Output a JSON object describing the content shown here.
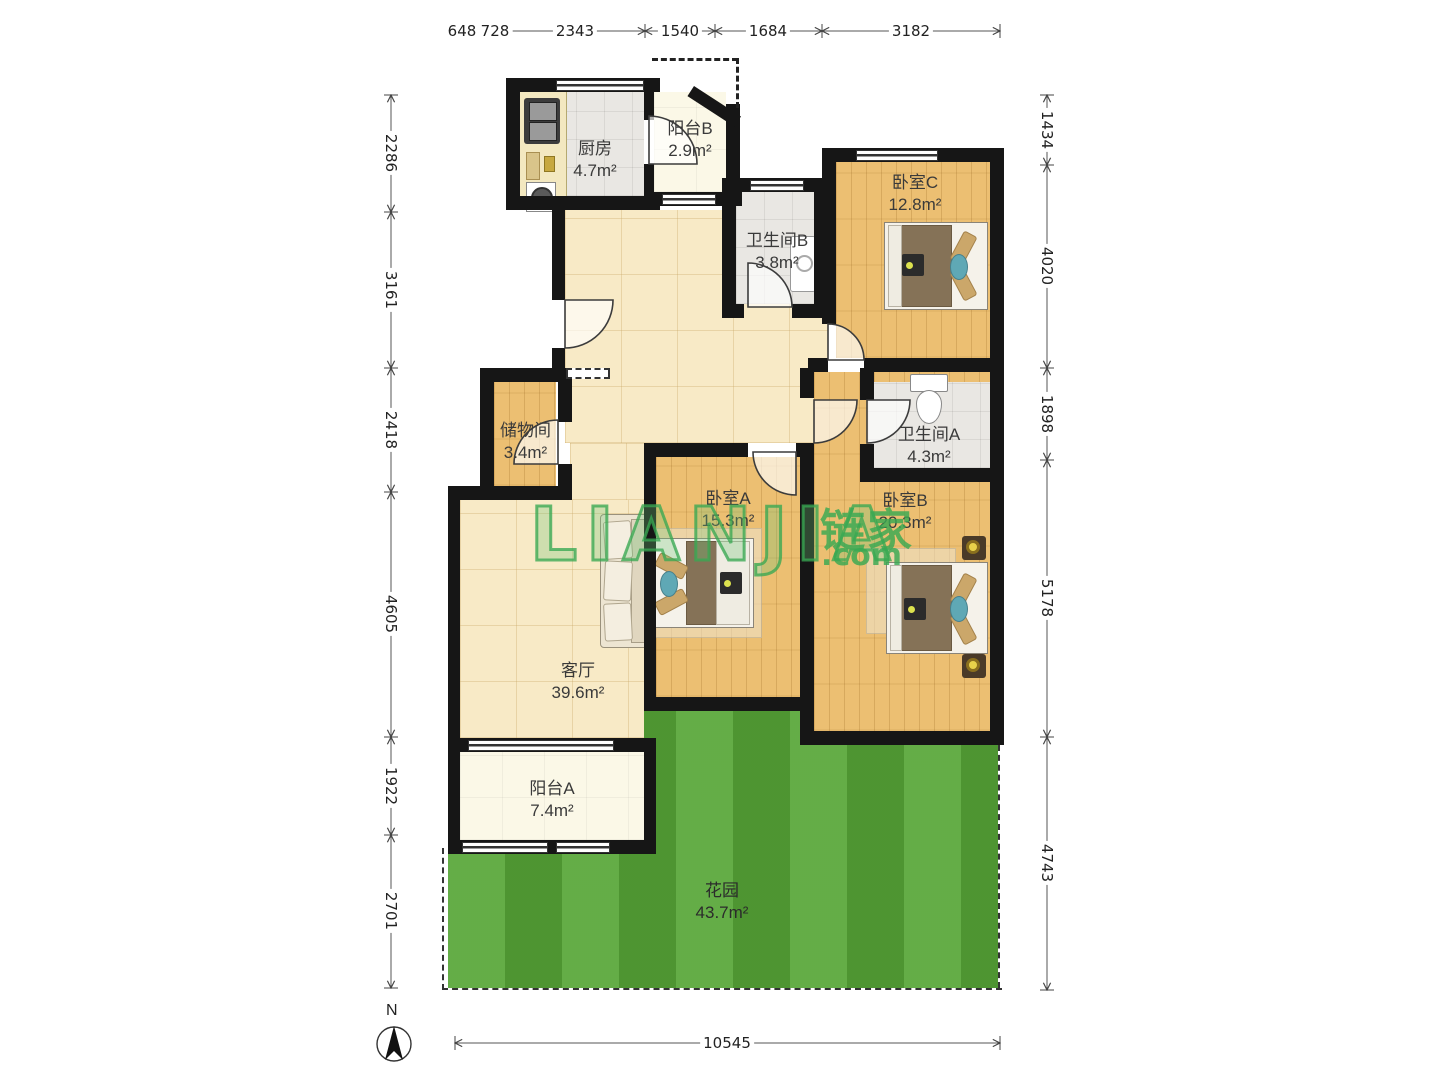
{
  "meta": {
    "north_label": "N"
  },
  "watermark": {
    "brand": "LIANJIA",
    "brand_cn": "链家",
    "suffix": ".com"
  },
  "rooms": {
    "kitchen": {
      "name": "厨房",
      "area": "4.7m²"
    },
    "balcony_b": {
      "name": "阳台B",
      "area": "2.9m²"
    },
    "bedroom_c": {
      "name": "卧室C",
      "area": "12.8m²"
    },
    "bathroom_b": {
      "name": "卫生间B",
      "area": "3.8m²"
    },
    "storage": {
      "name": "储物间",
      "area": "3.4m²"
    },
    "bathroom_a": {
      "name": "卫生间A",
      "area": "4.3m²"
    },
    "bedroom_a": {
      "name": "卧室A",
      "area": "15.3m²"
    },
    "bedroom_b": {
      "name": "卧室B",
      "area": "20.3m²"
    },
    "living_room": {
      "name": "客厅",
      "area": "39.6m²"
    },
    "balcony_a": {
      "name": "阳台A",
      "area": "7.4m²"
    },
    "garden": {
      "name": "花园",
      "area": "43.7m²"
    }
  },
  "dimensions": {
    "top": [
      "648",
      "728",
      "2343",
      "1540",
      "1684",
      "3182"
    ],
    "left": [
      "2286",
      "3161",
      "2418",
      "4605",
      "1922",
      "2701"
    ],
    "right": [
      "1434",
      "4020",
      "1898",
      "5178",
      "4743"
    ],
    "bottom": [
      "10545"
    ]
  },
  "colors": {
    "wall": "#161616",
    "wood_floor": "#ecbf72",
    "tile_floor": "#f8eac6",
    "garden_green": "#57a637",
    "watermark_green": "#38a852"
  }
}
